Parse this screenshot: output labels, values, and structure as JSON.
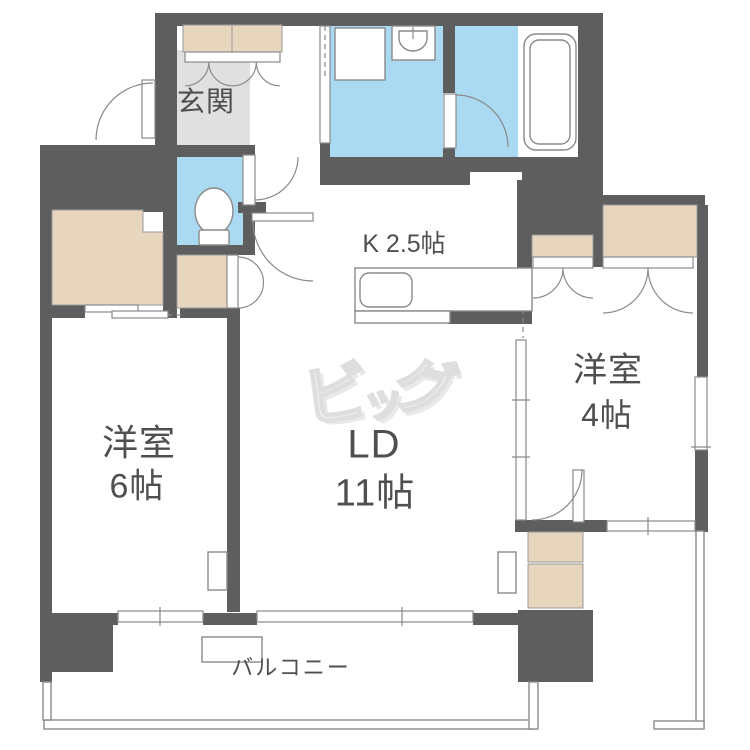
{
  "colors": {
    "wall": "#5e5e5e",
    "water": "#a9daf2",
    "closet": "#e7d6bd",
    "genkan": "#e0e0e0",
    "line": "#8a8a8a",
    "text": "#4f4f4f",
    "watermark": "#dedede"
  },
  "plan": {
    "entrance_label": "玄関",
    "kitchen_label": "K 2.5帖",
    "living_label_line1": "LD",
    "living_label_line2": "11帖",
    "bedroom_left_line1": "洋室",
    "bedroom_left_line2": "6帖",
    "bedroom_right_line1": "洋室",
    "bedroom_right_line2": "4帖",
    "balcony_label": "バルコニー",
    "watermark": {
      "char1": "ビ",
      "char2": "ッ",
      "char3": "グ"
    }
  }
}
